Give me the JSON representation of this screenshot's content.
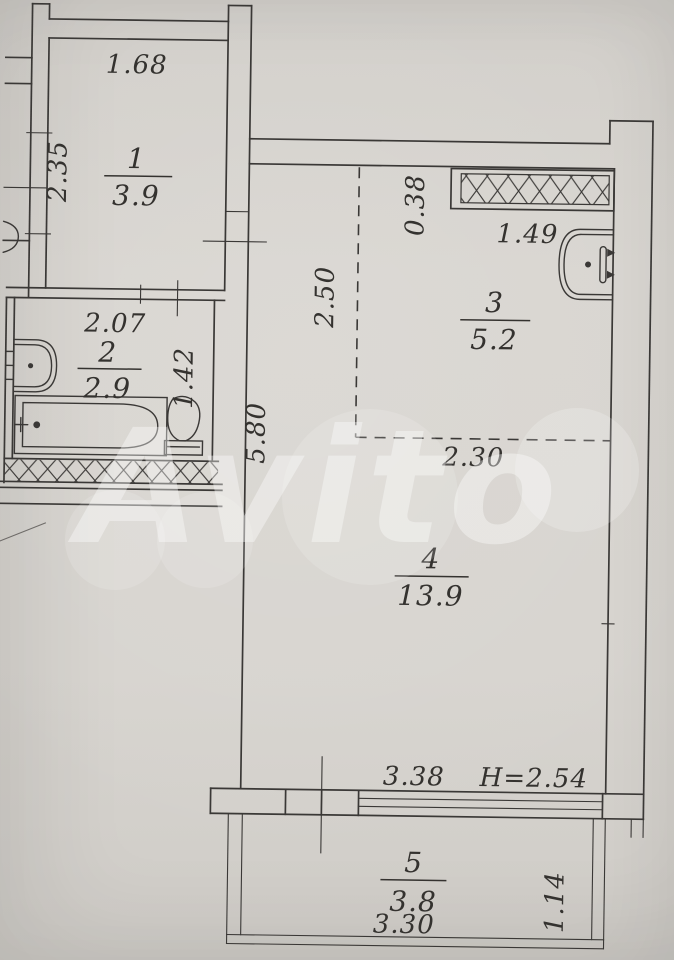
{
  "watermark": {
    "text": "Avito"
  },
  "colors": {
    "paper": "#d7d4cf",
    "line": "#3a3836",
    "watermark": "#ffffff"
  },
  "rooms": {
    "r1": {
      "number": "1",
      "area": "3.9"
    },
    "r2": {
      "number": "2",
      "area": "2.9"
    },
    "r3": {
      "number": "3",
      "area": "5.2"
    },
    "r4": {
      "number": "4",
      "area": "13.9"
    },
    "r5": {
      "number": "5",
      "area": "3.8"
    }
  },
  "dims": {
    "room1_width": "1.68",
    "room1_depth": "2.35",
    "room2_width": "2.07",
    "room2_depth": "1.42",
    "vent_offset": "0.38",
    "vent_width": "1.49",
    "room3_depth": "2.50",
    "room3_width": "2.30",
    "room4_depth": "5.80",
    "room4_width": "3.38",
    "ceiling_height": "H=2.54",
    "balcony_width": "3.30",
    "balcony_depth": "1.14"
  }
}
